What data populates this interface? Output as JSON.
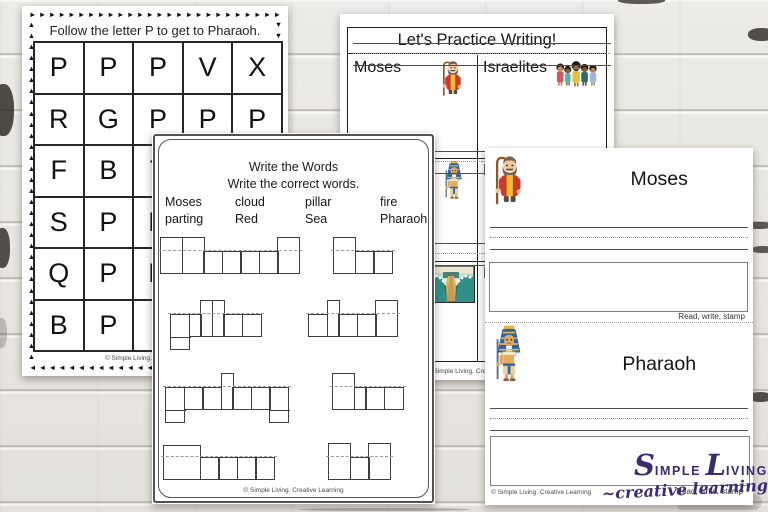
{
  "maze_sheet": {
    "title": "Follow the letter P to get to Pharaoh.",
    "grid_rows": [
      [
        "P",
        "P",
        "P",
        "V",
        "X"
      ],
      [
        "R",
        "G",
        "P",
        "P",
        "P"
      ],
      [
        "F",
        "B",
        "T",
        "",
        ""
      ],
      [
        "S",
        "P",
        "H",
        "",
        ""
      ],
      [
        "Q",
        "P",
        "H",
        "",
        ""
      ],
      [
        "B",
        "P",
        "I",
        "",
        ""
      ]
    ],
    "border_arrows": {
      "top": "►",
      "right": "▼",
      "bottom": "◄",
      "left": "▲"
    },
    "credit": "© Simple Living. Creative Learning"
  },
  "practice_sheet": {
    "title": "Let's Practice Writing!",
    "cells": [
      {
        "label": "Moses",
        "icon": "moses-icon"
      },
      {
        "label": "Israelites",
        "icon": "israelites-icon"
      },
      {
        "label": "",
        "icon": "pharaoh-icon"
      },
      {
        "label": "E",
        "icon": ""
      },
      {
        "label": "",
        "icon": "red-sea-icon"
      },
      {
        "label": "R",
        "icon": ""
      }
    ],
    "credit": "© Simple Living. Creative Learning"
  },
  "write_words_sheet": {
    "title_line1": "Write the Words",
    "title_line2": "Write the correct words.",
    "word_bank": [
      {
        "top": "Moses",
        "bottom": "parting"
      },
      {
        "top": "cloud",
        "bottom": "Red"
      },
      {
        "top": "pillar",
        "bottom": "Sea"
      },
      {
        "top": "fire",
        "bottom": "Pharaoh"
      }
    ],
    "word_shapes": [
      {
        "word": "Pharaoh",
        "pattern": [
          "T",
          "T",
          "s",
          "s",
          "s",
          "s",
          "T"
        ]
      },
      {
        "word": "Sea",
        "pattern": [
          "T",
          "s",
          "s"
        ]
      },
      {
        "word": "pillar",
        "pattern": [
          "d",
          "sn",
          "tn",
          "tn",
          "s",
          "s"
        ]
      },
      {
        "word": "cloud",
        "pattern": [
          "s",
          "tn",
          "s",
          "s",
          "T"
        ]
      },
      {
        "word": "parting",
        "pattern": [
          "d",
          "s",
          "s",
          "tn",
          "s",
          "s",
          "d"
        ]
      },
      {
        "word": "fire",
        "pattern": [
          "T",
          "sn",
          "s",
          "s"
        ]
      },
      {
        "word": "Moses",
        "pattern": [
          "Tw",
          "s",
          "s",
          "s",
          "s"
        ]
      },
      {
        "word": "Red",
        "pattern": [
          "T",
          "s",
          "T"
        ]
      }
    ],
    "credit": "© Simple Living. Creative Learning"
  },
  "stamp_sheet": {
    "sections": [
      {
        "title": "Moses",
        "icon": "moses-icon",
        "caption": "Read, write, stamp"
      },
      {
        "title": "Pharaoh",
        "icon": "pharaoh-icon",
        "caption": "Read, write, stamp"
      }
    ],
    "credit": "© Simple Living. Creative Learning"
  },
  "logo": {
    "part1": "S",
    "part2": "IMPLE",
    "part3": "L",
    "part4": "IVING",
    "line2": "~creative learning",
    "color": "#3b2b70"
  },
  "colors": {
    "logo_purple": "#3b2b70",
    "moses_robe_red": "#cd3a2c",
    "moses_sash_yellow": "#f0c12a",
    "pharaoh_blue": "#2c62a8",
    "pharaoh_gold": "#e9b73b",
    "sea_teal": "#2f8f8a"
  }
}
